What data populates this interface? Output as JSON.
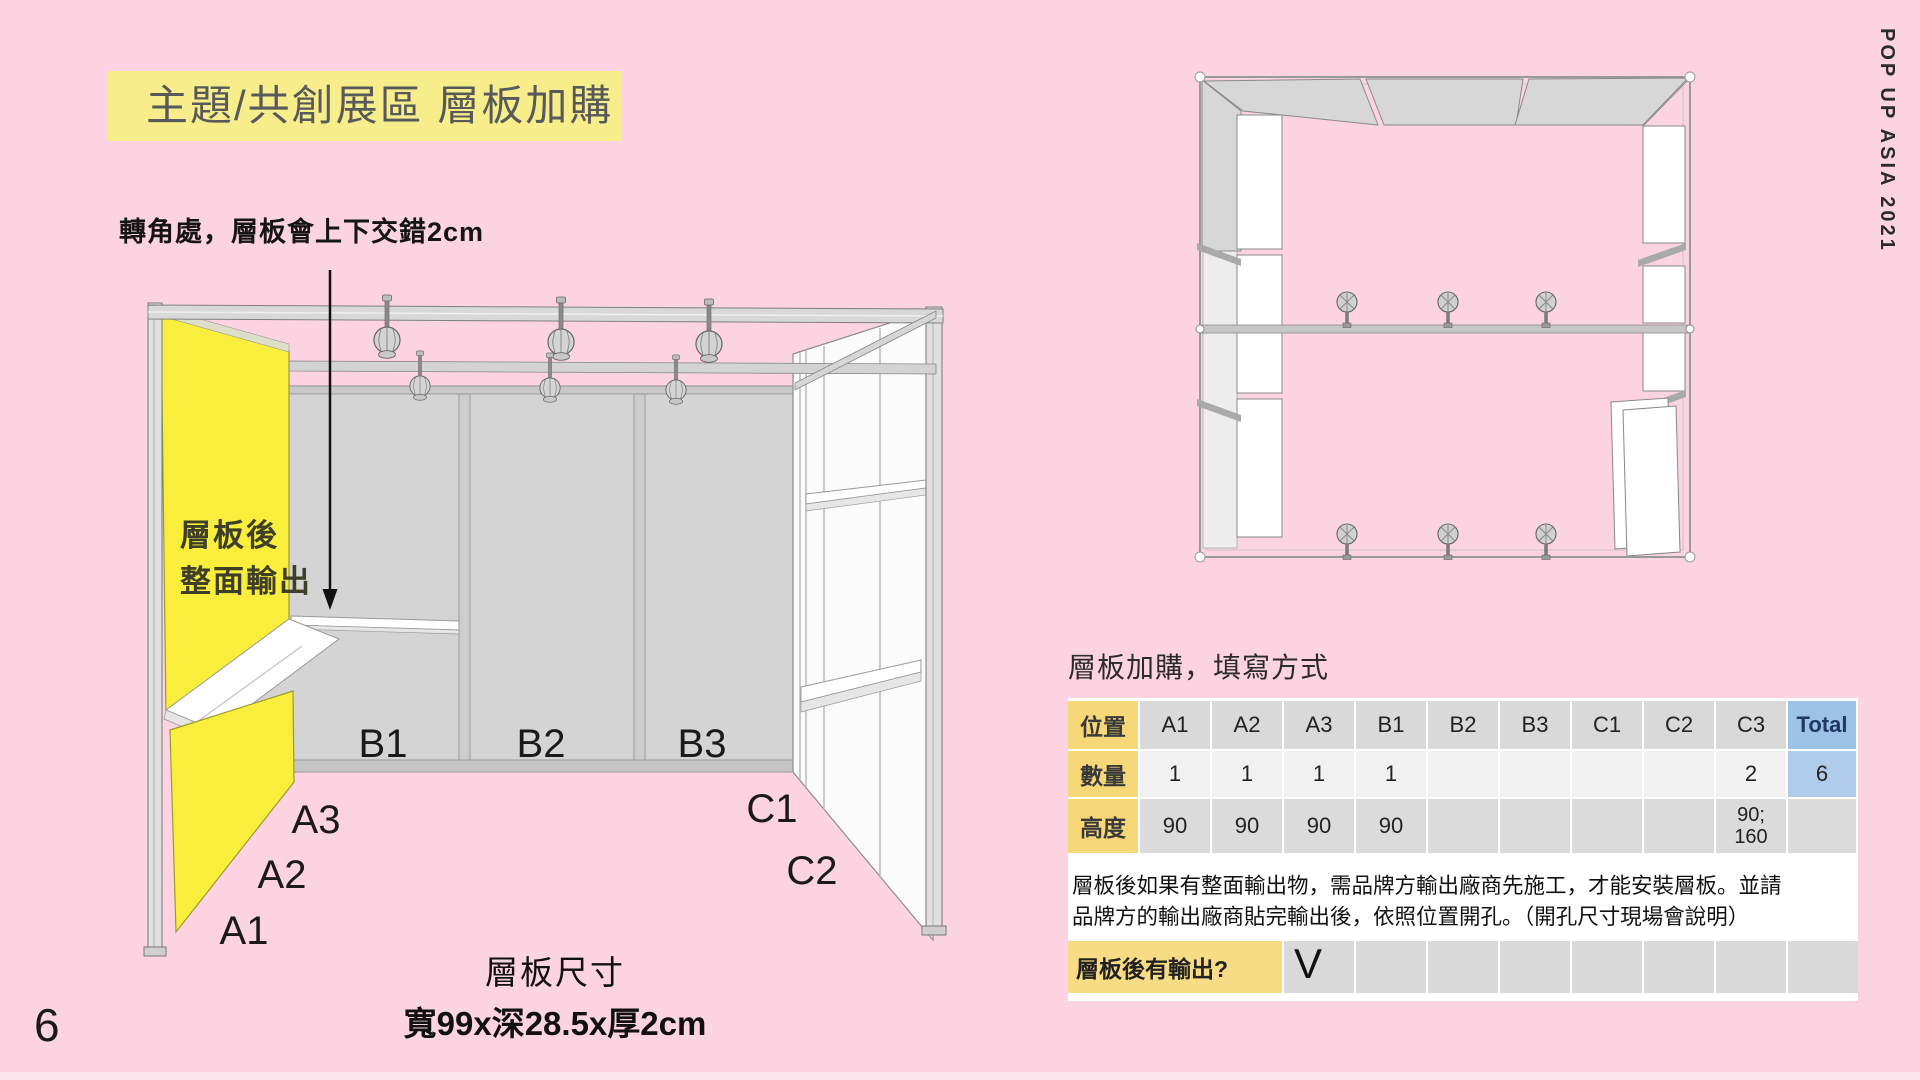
{
  "page": {
    "number": "6",
    "banner": "POP UP ASIA 2021"
  },
  "title": "主題/共創展區 層板加購",
  "annotation": "轉角處，層板會上下交錯2cm",
  "booth": {
    "panel_note_line1": "層板後",
    "panel_note_line2": "整面輸出",
    "labels": {
      "a1": "A1",
      "a2": "A2",
      "a3": "A3",
      "b1": "B1",
      "b2": "B2",
      "b3": "B3",
      "c1": "C1",
      "c2": "C2"
    },
    "caption_line1": "層板尺寸",
    "caption_line2": "寬99x深28.5x厚2cm"
  },
  "form": {
    "heading": "層板加購，填寫方式",
    "position_label": "位置",
    "columns": [
      "A1",
      "A2",
      "A3",
      "B1",
      "B2",
      "B3",
      "C1",
      "C2",
      "C3"
    ],
    "total_label": "Total",
    "qty_label": "數量",
    "qty": [
      "1",
      "1",
      "1",
      "1",
      "",
      "",
      "",
      "",
      "2"
    ],
    "qty_total": "6",
    "height_label": "高度",
    "heights": [
      "90",
      "90",
      "90",
      "90",
      "",
      "",
      "",
      "",
      "90;\n160"
    ],
    "height_total": "",
    "notes_line1": "層板後如果有整面輸出物，需品牌方輸出廠商先施工，才能安裝層板。並請",
    "notes_line2": "品牌方的輸出廠商貼完輸出後，依照位置開孔。（開孔尺寸現場會說明）",
    "output_label": "層板後有輸出?",
    "output_mark": "V"
  },
  "colors": {
    "background": "#FCD3E1",
    "title_highlight": "#F7ED8A",
    "panel_yellow": "#F8EE3B",
    "label_yellow": "#F7D879",
    "header_gray": "#D9D9D9",
    "total_blue": "#9CC2E5"
  }
}
